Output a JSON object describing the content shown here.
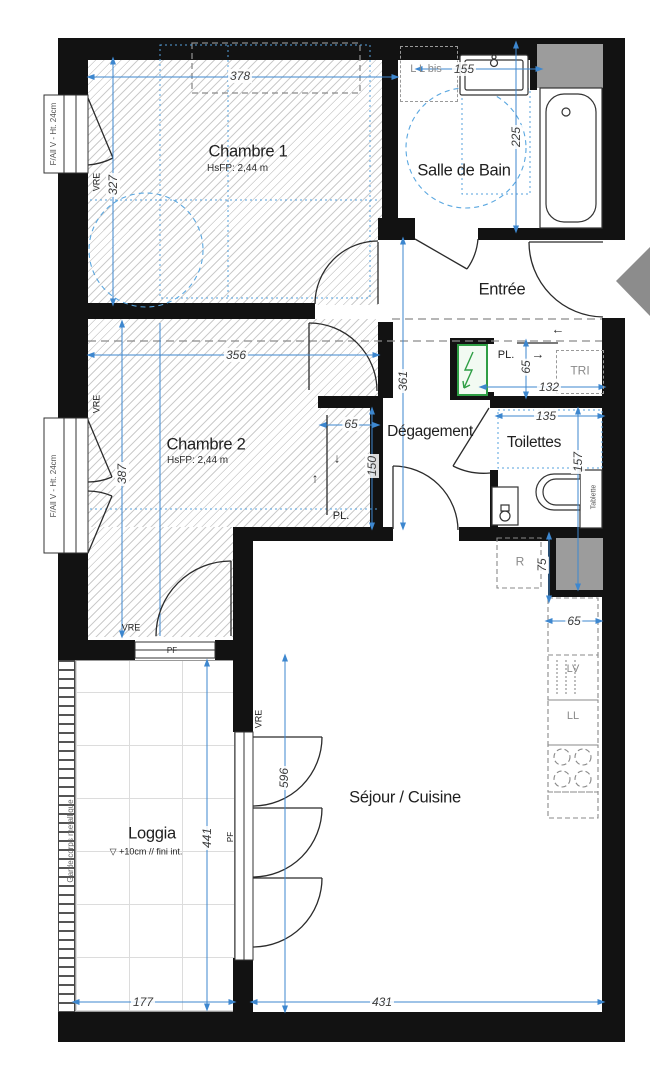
{
  "title": "floor-plan-T3-apartment",
  "rooms": {
    "chambre1": {
      "name": "Chambre 1",
      "ceiling": "HsFP: 2,44 m"
    },
    "chambre2": {
      "name": "Chambre 2",
      "ceiling": "HsFP: 2,44 m"
    },
    "salle_de_bain": {
      "name": "Salle de Bain"
    },
    "entree": {
      "name": "Entrée"
    },
    "degagement": {
      "name": "Dégagement"
    },
    "toilettes": {
      "name": "Toilettes"
    },
    "sejour": {
      "name": "Séjour / Cuisine"
    },
    "loggia": {
      "name": "Loggia",
      "note": "▽ +10cm // fini int."
    }
  },
  "dims": {
    "chambre1_w": "378",
    "chambre1_h": "327",
    "bain_w": "155",
    "bain_h": "225",
    "degagement_h": "361",
    "chambre2_w": "356",
    "chambre2_h": "387",
    "pl2_w": "65",
    "pl2_h": "150",
    "pl_entree_h": "65",
    "pl_entree_w": "132",
    "toilettes_w": "135",
    "toilettes_h": "157",
    "frigo_h": "75",
    "cuisine_w": "65",
    "sejour_h": "596",
    "sejour_w": "431",
    "loggia_h": "441",
    "loggia_w": "177"
  },
  "closets": {
    "pl": "PL."
  },
  "equipment": {
    "tri": "TRI",
    "frigo": "R",
    "lave_vaisselle": "LV",
    "lave_linge": "LL",
    "lave_linge_bis": "L L bis",
    "tablette": "Tablette"
  },
  "windows": {
    "left_window_label": "F/All V - Ht. 24cm",
    "vre": "VRE",
    "pf": "PF"
  },
  "loggia_extra": {
    "garde_corps": "Garde-corps metallique"
  },
  "arrows": {
    "left": "←",
    "right": "→",
    "up": "↑",
    "down": "↓"
  },
  "colors": {
    "dim_blue": "#3d87cf",
    "panel_green": "#2e9e44",
    "duct_gray": "#9c9c9c",
    "entry_triangle_gray": "#8c8c8c",
    "wall_black": "#121212"
  }
}
